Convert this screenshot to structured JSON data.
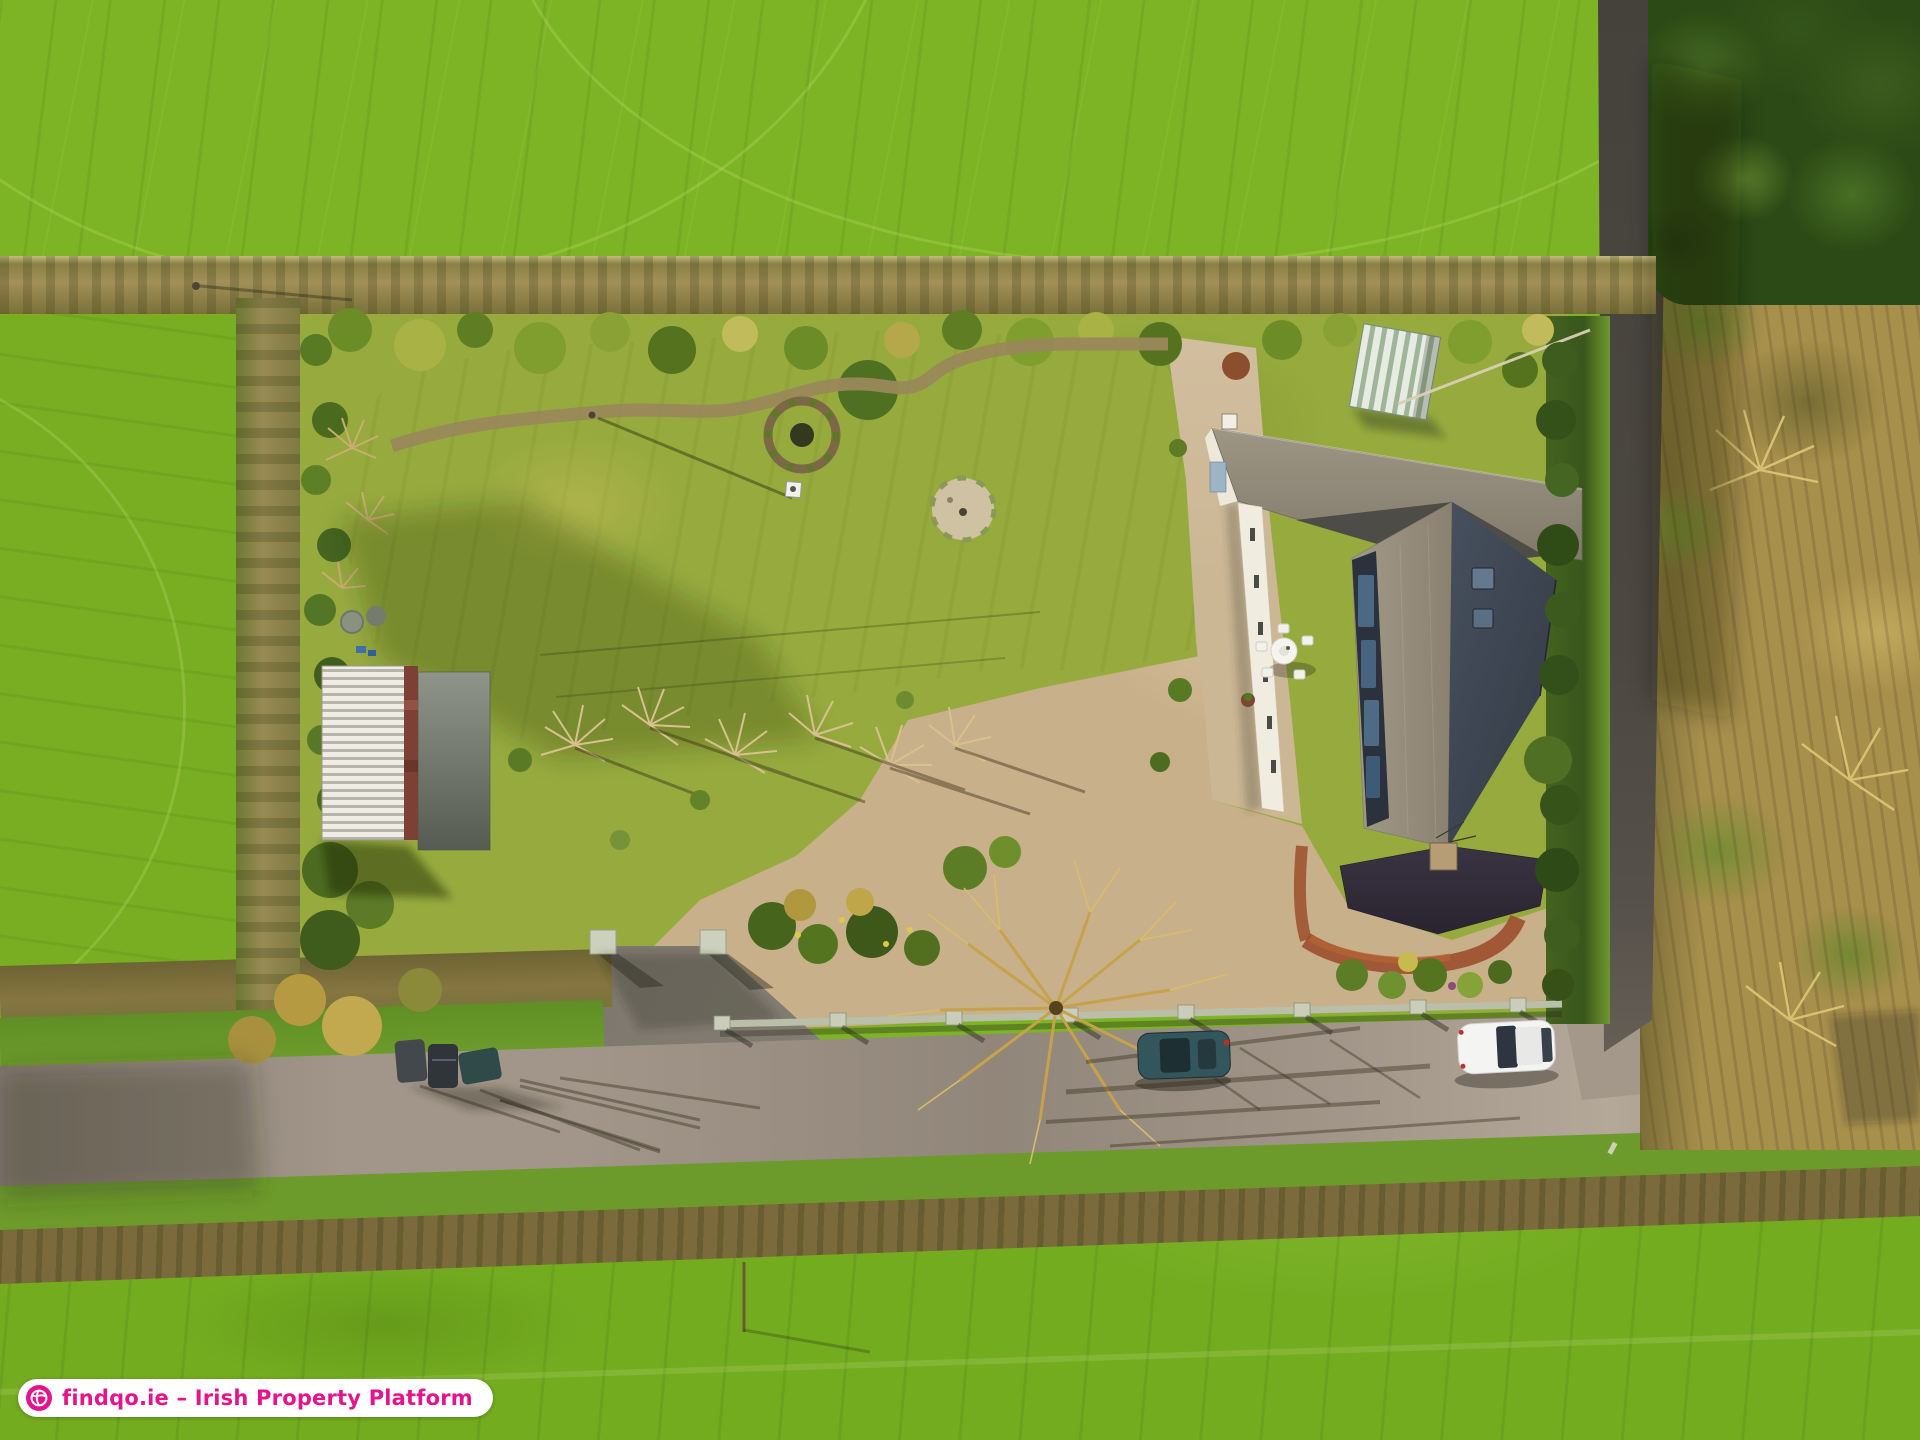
{
  "watermark": {
    "text": "findqo.ie – Irish Property Platform",
    "icon": "globe-icon",
    "text_color": "#e6148c",
    "background": "#ffffff"
  },
  "colors": {
    "brand_pink": "#e6148c",
    "badge_bg": "#ffffff",
    "field_top": "#7db425",
    "field_left": "#79ad22",
    "field_bottom": "#74ac20",
    "hedge_tan": "#a29058",
    "hedge_green_dark": "#3a561c",
    "lawn": "#97aa3e",
    "mulch": "#6d5134",
    "gravel": "#ccb795",
    "road": "#a2968a",
    "lane_dark": "#45423c",
    "roof_rear": "#968f7e",
    "roof_sun": "#9b9381",
    "roof_shade": "#424a57",
    "roof_front": "#39333f",
    "solar_panel": "#4e6f8e",
    "shed_white": "#eceae2",
    "shed_rust": "#7c4034",
    "greenhouse_green": "#9fb59a",
    "wall_coping": "#c9cdb9",
    "car_white": "#f4f4f2",
    "car_teal": "#33555c",
    "scrub_gold": "#a78f4c",
    "tree_gold": "#c6a24b"
  }
}
